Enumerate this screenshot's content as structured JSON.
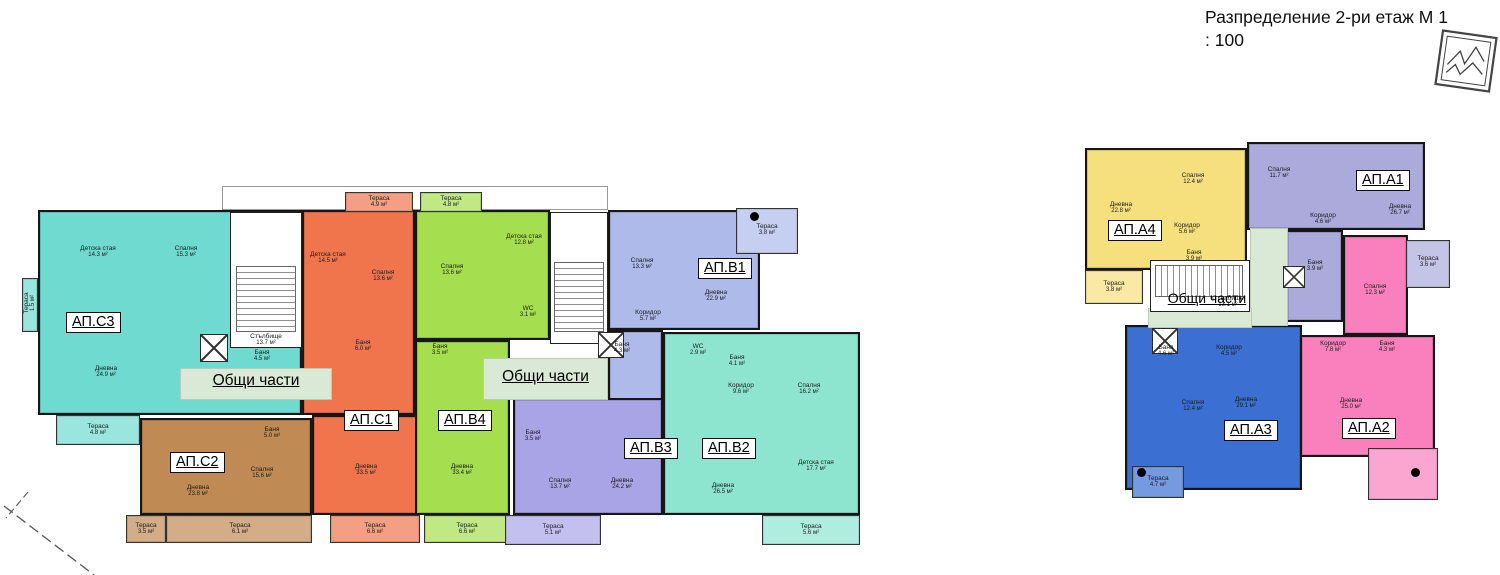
{
  "title": "Разпределение 2-ри етаж М 1 : 100",
  "common_label": "Общи части",
  "left_building": {
    "stairwell": {
      "name": "Стълбище",
      "area": "13.7 м²"
    },
    "apartments": {
      "c3": {
        "id": "АП.С3",
        "color": "#6edad0",
        "rooms": {
          "kids": {
            "name": "Детска стая",
            "area": "14.3 м²"
          },
          "bed": {
            "name": "Спалня",
            "area": "15.3 м²"
          },
          "bath": {
            "name": "Баня",
            "area": "4.5 м²"
          },
          "living": {
            "name": "Дневна",
            "area": "24.9 м²"
          },
          "ter_left": {
            "name": "Тераса",
            "area": "1.5 м²"
          },
          "ter": {
            "name": "Тераса",
            "area": "4.8 м²"
          }
        }
      },
      "c1": {
        "id": "АП.С1",
        "color": "#f0754d",
        "rooms": {
          "ter_top": {
            "name": "Тераса",
            "area": "4.9 м²"
          },
          "kids": {
            "name": "Детска стая",
            "area": "14.5 м²"
          },
          "bed": {
            "name": "Спалня",
            "area": "13.6 м²"
          },
          "bath": {
            "name": "Баня",
            "area": "6.0 м²"
          },
          "living": {
            "name": "Дневна",
            "area": "33.5 м²"
          },
          "ter": {
            "name": "Тераса",
            "area": "6.6 м²"
          }
        }
      },
      "b4": {
        "id": "АП.В4",
        "color": "#a5de4f",
        "rooms": {
          "ter_top": {
            "name": "Тераса",
            "area": "4.8 м²"
          },
          "bed": {
            "name": "Спалня",
            "area": "13.6 м²"
          },
          "kids": {
            "name": "Детска стая",
            "area": "12.8 м²"
          },
          "wc": {
            "name": "WC",
            "area": "3.1 м²"
          },
          "bath": {
            "name": "Баня",
            "area": "3.5 м²"
          },
          "living": {
            "name": "Дневна",
            "area": "33.4 м²"
          },
          "ter": {
            "name": "Тераса",
            "area": "6.6 м²"
          }
        }
      },
      "b1": {
        "id": "АП.В1",
        "color": "#aebaea",
        "rooms": {
          "bed": {
            "name": "Спалня",
            "area": "13.3 м²"
          },
          "ter": {
            "name": "Тераса",
            "area": "3.8 м²"
          },
          "living": {
            "name": "Дневна",
            "area": "22.9 м²"
          },
          "corridor": {
            "name": "Коридор",
            "area": "5.7 м²"
          },
          "bath": {
            "name": "Баня",
            "area": "4.3 м²"
          }
        }
      },
      "c2": {
        "id": "АП.С2",
        "color": "#c08a54",
        "rooms": {
          "bath": {
            "name": "Баня",
            "area": "5.0 м²"
          },
          "bed": {
            "name": "Спалня",
            "area": "15.6 м²"
          },
          "living": {
            "name": "Дневна",
            "area": "23.8 м²"
          },
          "ter1": {
            "name": "Тераса",
            "area": "3.5 м²"
          },
          "ter2": {
            "name": "Тераса",
            "area": "6.1 м²"
          }
        }
      },
      "b3": {
        "id": "АП.В3",
        "color": "#a9a4e6",
        "rooms": {
          "bath": {
            "name": "Баня",
            "area": "3.5 м²"
          },
          "bed": {
            "name": "Спалня",
            "area": "13.7 м²"
          },
          "living": {
            "name": "Дневна",
            "area": "24.2 м²"
          },
          "ter": {
            "name": "Тераса",
            "area": "5.1 м²"
          }
        }
      },
      "b2": {
        "id": "АП.В2",
        "color": "#8de5d0",
        "rooms": {
          "wc": {
            "name": "WC",
            "area": "2.9 м²"
          },
          "bath": {
            "name": "Баня",
            "area": "4.1 м²"
          },
          "corridor": {
            "name": "Коридор",
            "area": "9.6 м²"
          },
          "bed": {
            "name": "Спалня",
            "area": "16.2 м²"
          },
          "living": {
            "name": "Дневна",
            "area": "26.5 м²"
          },
          "kids": {
            "name": "Детска стая",
            "area": "17.7 м²"
          },
          "ter": {
            "name": "Тераса",
            "area": "5.6 м²"
          }
        }
      }
    }
  },
  "right_building": {
    "stairwell": {
      "name": "Стълбище",
      "area": "13.1 м²"
    },
    "apartments": {
      "a4": {
        "id": "АП.А4",
        "color": "#f6e07d",
        "rooms": {
          "living": {
            "name": "Дневна",
            "area": "22.8 м²"
          },
          "bed": {
            "name": "Спалня",
            "area": "12.4 м²"
          },
          "corridor": {
            "name": "Коридор",
            "area": "5.6 м²"
          },
          "bath": {
            "name": "Баня",
            "area": "3.9 м²"
          },
          "ter": {
            "name": "Тераса",
            "area": "3.8 м²"
          }
        }
      },
      "a1": {
        "id": "АП.А1",
        "color": "#abaadb",
        "rooms": {
          "bed": {
            "name": "Спалня",
            "area": "11.7 м²"
          },
          "corridor": {
            "name": "Коридор",
            "area": "4.6 м²"
          },
          "living": {
            "name": "Дневна",
            "area": "26.7 м²"
          },
          "bath": {
            "name": "Баня",
            "area": "3.9 м²"
          },
          "ter": {
            "name": "Тераса",
            "area": "3.6 м²"
          }
        }
      },
      "a3": {
        "id": "АП.А3",
        "color": "#3b6fd1",
        "rooms": {
          "bath": {
            "name": "Баня",
            "area": "4.6 м²"
          },
          "corridor": {
            "name": "Коридор",
            "area": "4.5 м²"
          },
          "bed": {
            "name": "Спалня",
            "area": "12.4 м²"
          },
          "living": {
            "name": "Дневна",
            "area": "29.1 м²"
          },
          "ter": {
            "name": "Тераса",
            "area": "4.7 м²"
          }
        }
      },
      "a2": {
        "id": "АП.А2",
        "color": "#f980bc",
        "rooms": {
          "bed": {
            "name": "Спалня",
            "area": "12.3 м²"
          },
          "corridor": {
            "name": "Коридор",
            "area": "7.8 м²"
          },
          "bath": {
            "name": "Баня",
            "area": "4.3 м²"
          },
          "living": {
            "name": "Дневна",
            "area": "25.0 м²"
          }
        }
      }
    }
  }
}
